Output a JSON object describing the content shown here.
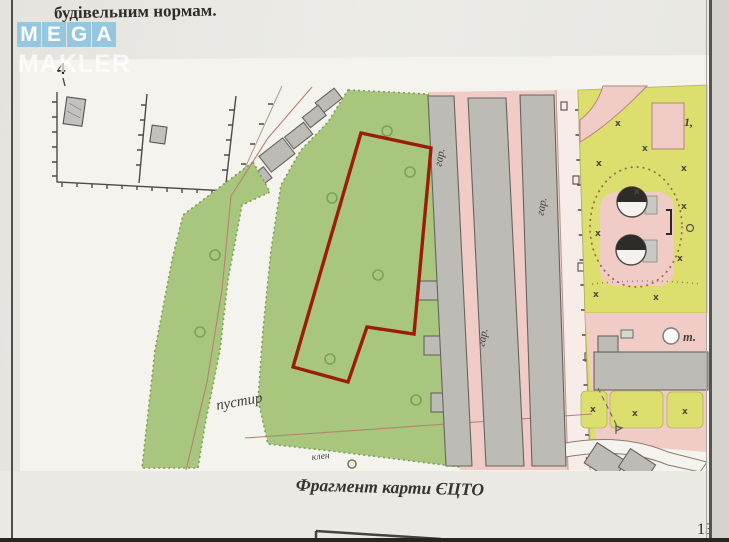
{
  "page": {
    "top_text": "будівельним нормам.",
    "figure_number": "4",
    "caption": "Фрагмент карти ЄЦТО",
    "page_number": "13"
  },
  "watermark": {
    "letters": [
      "M",
      "E",
      "G",
      "A"
    ],
    "word": "MAKLER"
  },
  "map": {
    "labels": {
      "garage": "гар.",
      "wasteland": "пустир",
      "maple": "клен",
      "point": "т.",
      "house_number": "1,"
    },
    "symbols": {
      "tree": "х"
    },
    "colors": {
      "parcel_outline_red": "#9c1c0c",
      "green_area": "#a8c67e",
      "lawn_yellow_green": "#dcdf6e",
      "built_up_pink": "#f1ccc7",
      "building_gray": "#bcbbb6",
      "watermark_blue": "#8fc5e1"
    }
  }
}
